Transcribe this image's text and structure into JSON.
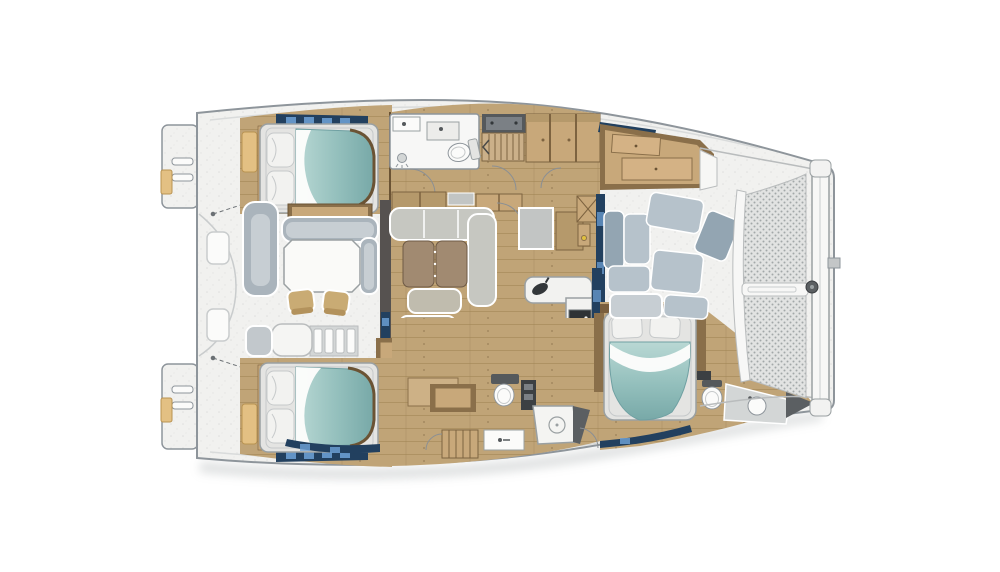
{
  "image": {
    "kind": "yacht-floorplan-illustration",
    "subject": "catamaran sailing yacht accommodation and deck plan, top view, bow to the right",
    "background": "#ffffff"
  },
  "palette": {
    "bg": "#ffffff",
    "hullStroke": "#8e959b",
    "deck": "#f1f1ef",
    "deckLine": "#c9cccd",
    "deckShade": "#d9dbdb",
    "woodFloor": "#c0a477",
    "woodLine": "#9c8050",
    "woodDark": "#6b5334",
    "cabinetTan": "#c8a87a",
    "cabinetMid": "#b5996b",
    "cabinetFace": "#7d6340",
    "lockerTan": "#e3c083",
    "lockerEdge": "#b99352",
    "tealLight": "#b9d8d4",
    "tealMid": "#93bfbc",
    "tealDeep": "#78a9a8",
    "tealEdge": "#6fa0a2",
    "linen": "#f2f2f0",
    "linenShade": "#c6c9ca",
    "frameFill": "#e4e4e2",
    "frameStroke": "#9aa0a2",
    "sofaGray": "#c6c7c1",
    "sofaLight": "#d9dad5",
    "cushionBrown": "#a18a71",
    "cushionEdge": "#6e5a45",
    "ottoman": "#c0bcae",
    "seatBlue": "#b6c2cb",
    "seatBlueLight": "#c7ced3",
    "seatBlueDeep": "#93a5b2",
    "chairTan": "#c9ab74",
    "chairTanDeep": "#b3925c",
    "navy": "#22405f",
    "navyGlint": "#6fa3d8",
    "fixture": "#fbfbfa",
    "fixtureStroke": "#8e959b",
    "applianceDark": "#2f3335",
    "applianceMid": "#7b8085",
    "steel": "#d3d6d6",
    "wedgeDark": "#5b5f62",
    "meshBg": "#e2e3e2",
    "meshDot": "#a3a8a8",
    "tread": "#cbb089",
    "treadLine": "#7c6441",
    "tanPanel": "#cdb186",
    "wallDark": "#565250",
    "shadow": "#9aa0a2"
  },
  "depicted_layout": {
    "orientation": "bow-right-stern-left",
    "stern": [
      "port transom platform with boarding ladder",
      "starboard transom platform with boarding ladder",
      "aft deck with two hatches and davit lines"
    ],
    "aft_cockpit": [
      "chaise lounge",
      "C-shaped bench",
      "wet-bar cabinet",
      "dining table",
      "two deck chairs",
      "cockpit steps"
    ],
    "port_hull_top": [
      "aft double cabin with teal berth",
      "en-suite head with toilet and two sinks",
      "companionway stairs",
      "hull cabinets",
      "nav desk with hanging locker",
      "forward storage"
    ],
    "saloon": [
      "L-shaped gray sofa",
      "two brown table leaves",
      "ottoman",
      "aft sliding-door wall",
      "forward glass door wall"
    ],
    "galley": [
      "island counter with cooktop",
      "L-shaped counter with sink",
      "dark appliance",
      "cabinet faces"
    ],
    "starboard_hull_bottom": [
      "aft double cabin with teal berth",
      "mid head with toilet, control panel, shower pan, sink and hanging locker",
      "forward double cabin with teal berth",
      "bow head with toilet, basin counter and anchor locker wedge"
    ],
    "forward_cockpit": [
      "U-shaped blue-gray seating"
    ],
    "bow": [
      "two trampoline mesh panels",
      "central divider bar",
      "curved inner frame",
      "forestay crossbar with furler drum"
    ]
  },
  "counts": {
    "berths": 3,
    "heads": 3,
    "toilets": 4,
    "tables": 3,
    "trampoline_panels": 2
  }
}
